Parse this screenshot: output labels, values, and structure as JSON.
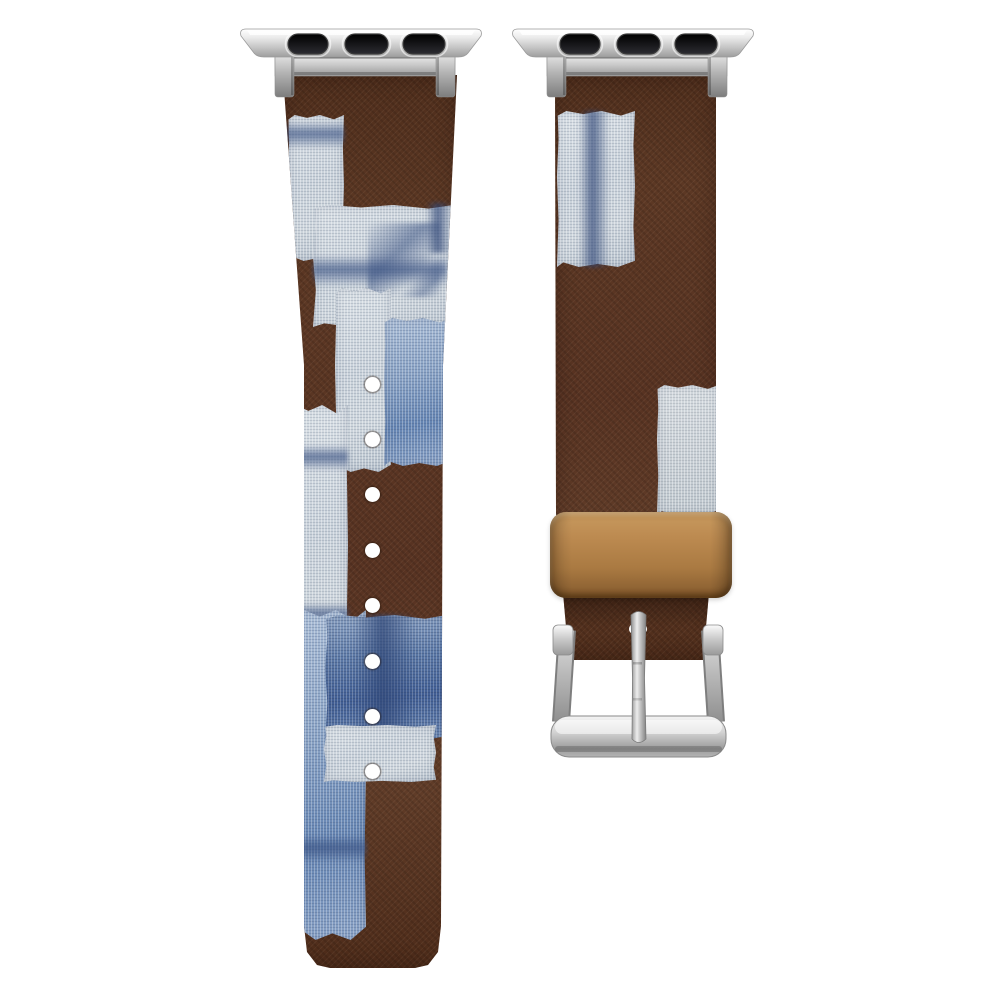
{
  "scene": {
    "background": "#ffffff",
    "alt": "Patchwork fabric watch band with silver lug adapters, tan keeper loop and silver buckle"
  },
  "palette": {
    "background": "#ffffff",
    "strap_brown": "#5c3824",
    "strap_brown_dark": "#46261a",
    "strap_brown_light": "#6b432c",
    "canvas_light": "#c8d1da",
    "canvas_gray": "#c9d0d6",
    "indigo": "#6484b2",
    "indigo_deep": "#415e94",
    "keeper_tan": "#bc8a50",
    "keeper_tan_dark": "#7d5527",
    "silver_bright": "#f7f7f7",
    "silver": "#cfcfcf",
    "silver_mid": "#a8a8a8",
    "silver_dark": "#808080",
    "slot_dark": "#151518",
    "hole_color": "#ffffff"
  },
  "left_strap": {
    "rect": {
      "x": 280,
      "y": 75,
      "w": 180,
      "h": 893
    },
    "holes": {
      "count": 8,
      "cx": 92,
      "y_start": 309,
      "spacing": 55.4,
      "d": 15
    },
    "patches": [
      {
        "k": "light",
        "x": 8,
        "y": 40,
        "w": 56,
        "h": 146
      },
      {
        "k": "streak-h",
        "x": 6,
        "y": 46,
        "w": 58,
        "h": 28
      },
      {
        "k": "light",
        "x": 33,
        "y": 130,
        "w": 141,
        "h": 122
      },
      {
        "k": "streak-d",
        "x": 88,
        "y": 148,
        "w": 72,
        "h": 74
      },
      {
        "k": "streak-h",
        "x": 33,
        "y": 180,
        "w": 134,
        "h": 32
      },
      {
        "k": "streak-v",
        "x": 146,
        "y": 128,
        "w": 26,
        "h": 50
      },
      {
        "k": "light",
        "x": 55,
        "y": 213,
        "w": 56,
        "h": 184
      },
      {
        "k": "blue",
        "x": 104,
        "y": 243,
        "w": 68,
        "h": 148
      },
      {
        "k": "light",
        "x": 8,
        "y": 330,
        "w": 60,
        "h": 292
      },
      {
        "k": "streak-h",
        "x": 8,
        "y": 370,
        "w": 60,
        "h": 26
      },
      {
        "k": "streak-h",
        "x": 8,
        "y": 528,
        "w": 60,
        "h": 24
      },
      {
        "k": "blue",
        "x": 16,
        "y": 535,
        "w": 70,
        "h": 330
      },
      {
        "k": "deep",
        "x": 45,
        "y": 540,
        "w": 122,
        "h": 126
      },
      {
        "k": "streak-v",
        "x": 74,
        "y": 540,
        "w": 62,
        "h": 126
      },
      {
        "k": "light",
        "x": 44,
        "y": 650,
        "w": 112,
        "h": 57
      },
      {
        "k": "streak-h",
        "x": 16,
        "y": 760,
        "w": 70,
        "h": 28
      }
    ]
  },
  "right_strap": {
    "rect": {
      "x": 553,
      "y": 75,
      "w": 166,
      "h": 585
    },
    "patches": [
      {
        "k": "light",
        "x": 4,
        "y": 36,
        "w": 78,
        "h": 156
      },
      {
        "k": "streak-v",
        "x": 26,
        "y": 36,
        "w": 30,
        "h": 156
      },
      {
        "k": "lightgray",
        "x": 104,
        "y": 310,
        "w": 62,
        "h": 130
      },
      {
        "k": "shade",
        "x": 8,
        "y": 518,
        "w": 150,
        "h": 34
      }
    ]
  },
  "keeper": {
    "rect": {
      "x": 550,
      "y": 512,
      "w": 182,
      "h": 86
    }
  },
  "buckle": {
    "rect": {
      "x": 545,
      "y": 600,
      "w": 185,
      "h": 165
    }
  },
  "hardware": {
    "slot_count": 3,
    "adapters": [
      {
        "x": 238,
        "y": 28,
        "w": 246,
        "h": 70
      },
      {
        "x": 510,
        "y": 28,
        "w": 246,
        "h": 70
      }
    ]
  }
}
